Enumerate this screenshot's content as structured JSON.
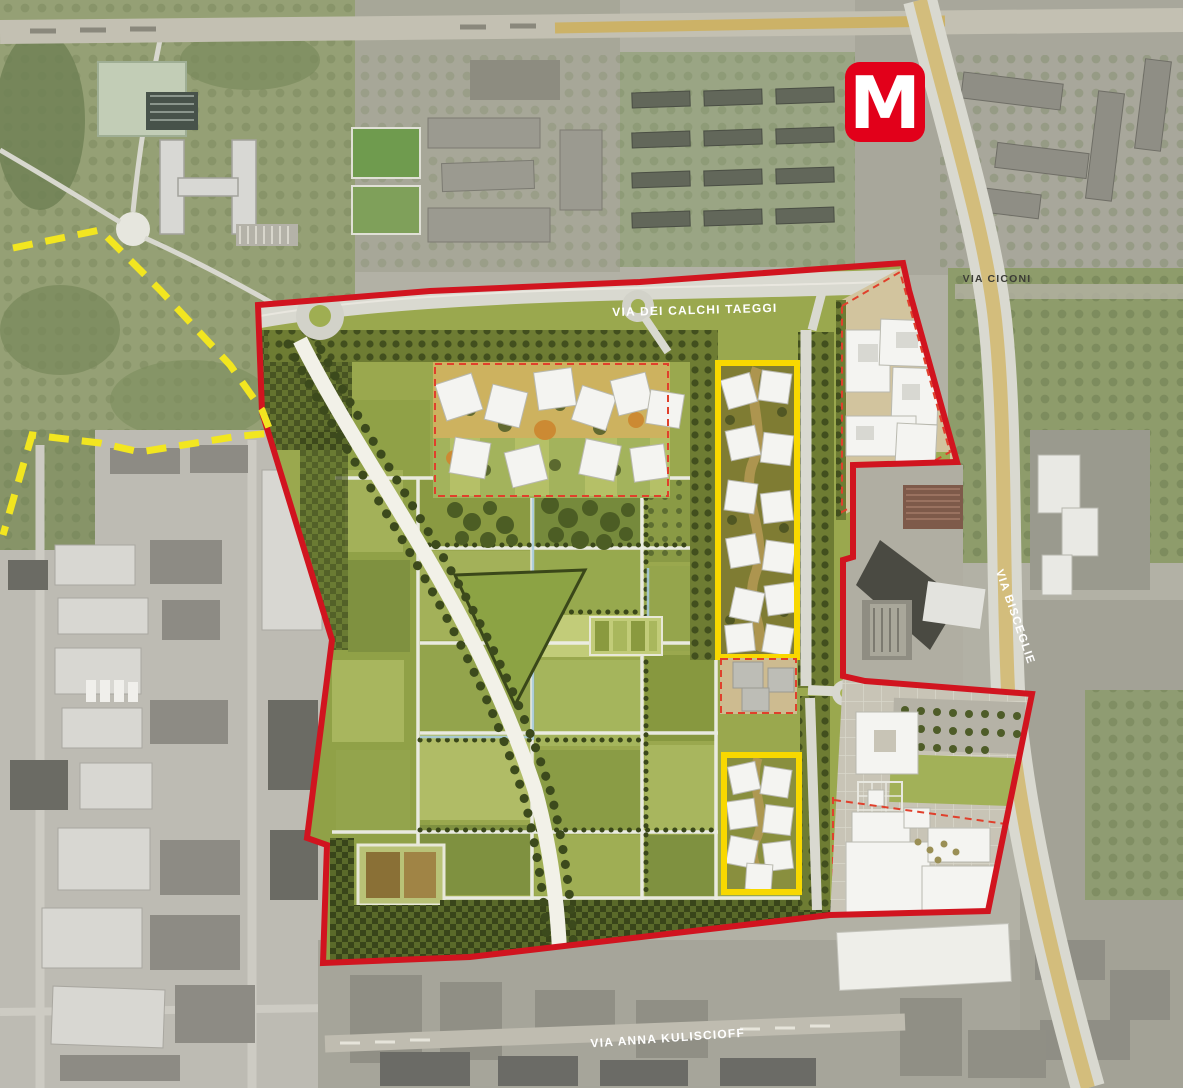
{
  "title": "Masterplan aerial site plan",
  "colors": {
    "boundary_red": "#d1141f",
    "inner_dash_red": "#e0402c",
    "zone_yellow": "#f8d800",
    "dash_yellow": "#f2e620",
    "metro_red": "#e2001a",
    "label_white": "#ffffff",
    "label_dark": "#3c3c36",
    "site_green": "#9aa84e",
    "road_gray": "#d9d9d0",
    "path_white": "#f2f1e8",
    "hedge_dark": "#3a4719",
    "tan": "#d2c49e",
    "building_white": "#f4f4f1",
    "building_gray": "#bdbdb6",
    "sat_base": "#b2b1a5",
    "road_yellow": "#cfae4e",
    "water_blue": "#a8cbdc"
  },
  "metro": {
    "letter": "M"
  },
  "labels": {
    "road_top": "VIA DEI CALCHI TAEGGI",
    "road_right_top": "VIA CICONI",
    "road_right": "VIA BISCEGLIE",
    "road_bottom": "VIA ANNA KULISCIOFF"
  }
}
